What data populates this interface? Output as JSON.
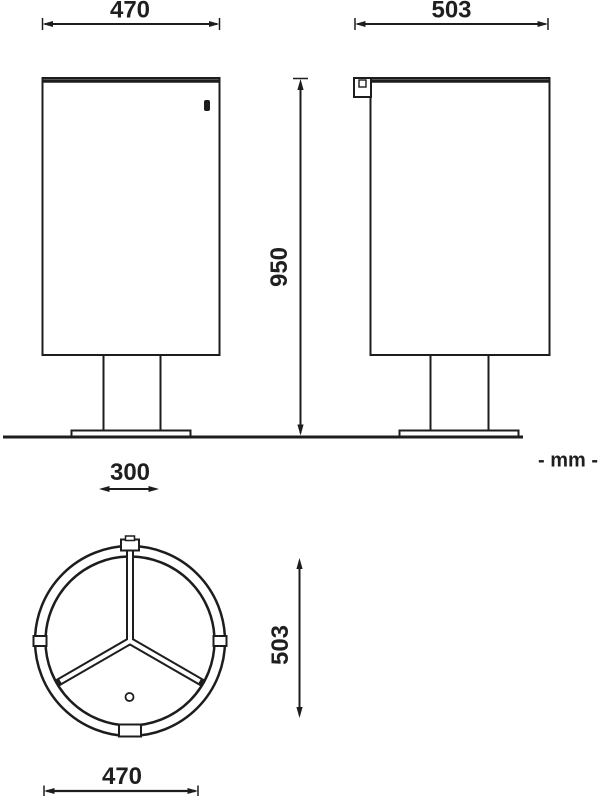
{
  "page": {
    "background": "#ffffff",
    "line_color": "#1d1d1d"
  },
  "unit": {
    "label": "- mm -"
  },
  "dims": {
    "front_width": "470",
    "side_depth": "503",
    "overall_height": "950",
    "base_width": "300",
    "top_view_depth": "503",
    "top_view_width": "470"
  }
}
